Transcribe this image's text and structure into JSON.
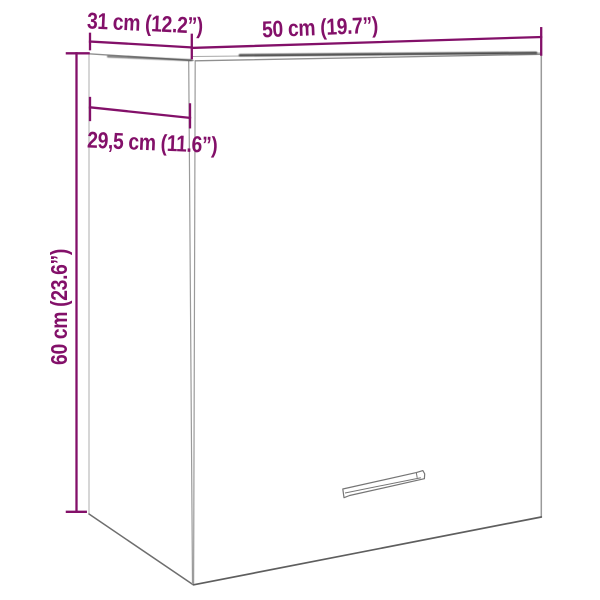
{
  "title": "Wall cabinet dimension diagram",
  "colors": {
    "accent": "#831069",
    "outline": "#8f8f8f",
    "outline_light": "#c9c9c9",
    "outline_dark": "#3a3a3a",
    "background": "#ffffff"
  },
  "labels": {
    "top_depth": "31 cm (12.2”)",
    "top_width": "50 cm (19.7”)",
    "inner_depth": "29,5 cm (11.6”)",
    "height": "60 cm (23.6”)"
  }
}
